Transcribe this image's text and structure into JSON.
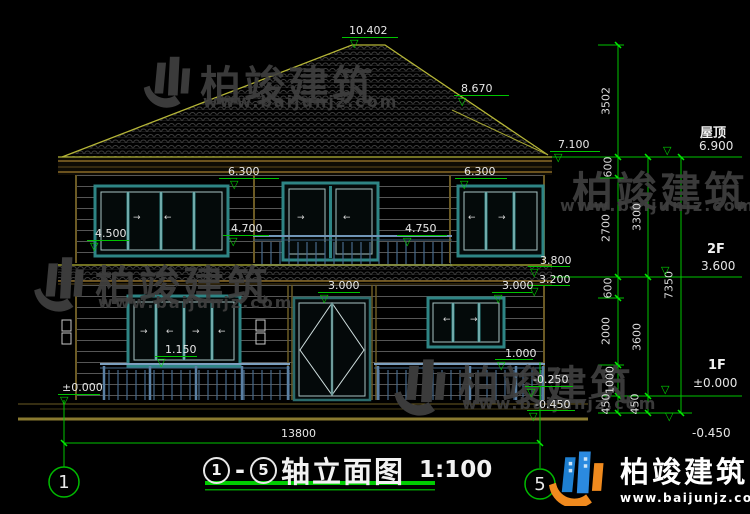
{
  "brand": {
    "name": "柏竣建筑",
    "site": "www.baijunjz.com"
  },
  "title": {
    "axis_from": "1",
    "dash": "-",
    "axis_to": "5",
    "name": "轴立面图",
    "scale": "1:100"
  },
  "axis_bubbles": {
    "left": "1",
    "right": "5"
  },
  "bottom_dim": "13800",
  "levels_right": {
    "roof": {
      "name": "屋顶",
      "value": "6.900"
    },
    "f2": {
      "name": "2F",
      "value": "3.600"
    },
    "f1": {
      "name": "1F",
      "value": "±0.000"
    },
    "ground": {
      "value": "-0.450"
    }
  },
  "elevation_markers": [
    {
      "label": "10.402",
      "x": 349,
      "y": 25,
      "lx": 342,
      "ly": 37,
      "lw": 56,
      "gx": 350,
      "gy": 38
    },
    {
      "label": "8.670",
      "x": 461,
      "y": 83,
      "lx": 454,
      "ly": 95,
      "lw": 55,
      "gx": 458,
      "gy": 96
    },
    {
      "label": "7.100",
      "x": 558,
      "y": 139,
      "lx": 550,
      "ly": 151,
      "lw": 50,
      "gx": 554,
      "gy": 152
    },
    {
      "label": "6.300",
      "x": 228,
      "y": 166,
      "lx": 219,
      "ly": 178,
      "lw": 60,
      "gx": 230,
      "gy": 179
    },
    {
      "label": "6.300",
      "x": 464,
      "y": 166,
      "lx": 455,
      "ly": 178,
      "lw": 52,
      "gx": 460,
      "gy": 179
    },
    {
      "label": "4.500",
      "x": 95,
      "y": 228,
      "lx": 87,
      "ly": 240,
      "lw": 42,
      "gx": 90,
      "gy": 241
    },
    {
      "label": "4.700",
      "x": 231,
      "y": 223,
      "lx": 223,
      "ly": 235,
      "lw": 46,
      "gx": 229,
      "gy": 236
    },
    {
      "label": "4.750",
      "x": 405,
      "y": 223,
      "lx": 397,
      "ly": 235,
      "lw": 50,
      "gx": 403,
      "gy": 236
    },
    {
      "label": "3.800",
      "x": 540,
      "y": 255,
      "lx": 528,
      "ly": 266,
      "lw": 42,
      "gx": 530,
      "gy": 267
    },
    {
      "label": "3.200",
      "x": 539,
      "y": 274,
      "lx": 528,
      "ly": 285,
      "lw": 42,
      "gx": 530,
      "gy": 286
    },
    {
      "label": "3.000",
      "x": 328,
      "y": 280,
      "lx": 318,
      "ly": 292,
      "lw": 42,
      "gx": 320,
      "gy": 293
    },
    {
      "label": "3.000",
      "x": 502,
      "y": 280,
      "lx": 492,
      "ly": 292,
      "lw": 40,
      "gx": 494,
      "gy": 293
    },
    {
      "label": "1.150",
      "x": 165,
      "y": 344,
      "lx": 155,
      "ly": 356,
      "lw": 42,
      "gx": 157,
      "gy": 357
    },
    {
      "label": "1.000",
      "x": 505,
      "y": 348,
      "lx": 495,
      "ly": 359,
      "lw": 38,
      "gx": 497,
      "gy": 360
    },
    {
      "label": "±0.000",
      "x": 62,
      "y": 382,
      "lx": 58,
      "ly": 394,
      "lw": 42,
      "gx": 60,
      "gy": 395
    },
    {
      "label": "-0.250",
      "x": 533,
      "y": 374,
      "lx": 525,
      "ly": 386,
      "lw": 48,
      "gx": 527,
      "gy": 387
    },
    {
      "label": "-0.450",
      "x": 535,
      "y": 399,
      "lx": 527,
      "ly": 410,
      "lw": 48,
      "gx": 529,
      "gy": 411
    }
  ],
  "vertical_dims": [
    {
      "label": "3502",
      "x": 606,
      "y": 101
    },
    {
      "label": "600",
      "x": 608,
      "y": 167
    },
    {
      "label": "2700",
      "x": 606,
      "y": 228
    },
    {
      "label": "600",
      "x": 608,
      "y": 288
    },
    {
      "label": "2000",
      "x": 606,
      "y": 331
    },
    {
      "label": "1000",
      "x": 610,
      "y": 380
    },
    {
      "label": "450",
      "x": 606,
      "y": 404
    },
    {
      "label": "3300",
      "x": 637,
      "y": 217
    },
    {
      "label": "3600",
      "x": 637,
      "y": 337
    },
    {
      "label": "450",
      "x": 635,
      "y": 404
    },
    {
      "label": "7350",
      "x": 669,
      "y": 285
    }
  ],
  "window_arrows": [
    {
      "char": "→",
      "x": 133,
      "y": 214
    },
    {
      "char": "←",
      "x": 164,
      "y": 214
    },
    {
      "char": "→",
      "x": 297,
      "y": 214
    },
    {
      "char": "←",
      "x": 343,
      "y": 214
    },
    {
      "char": "←",
      "x": 468,
      "y": 214
    },
    {
      "char": "→",
      "x": 498,
      "y": 214
    },
    {
      "char": "→",
      "x": 140,
      "y": 328
    },
    {
      "char": "←",
      "x": 166,
      "y": 328
    },
    {
      "char": "→",
      "x": 192,
      "y": 328
    },
    {
      "char": "←",
      "x": 218,
      "y": 328
    },
    {
      "char": "←",
      "x": 443,
      "y": 316
    },
    {
      "char": "→",
      "x": 470,
      "y": 316
    }
  ]
}
